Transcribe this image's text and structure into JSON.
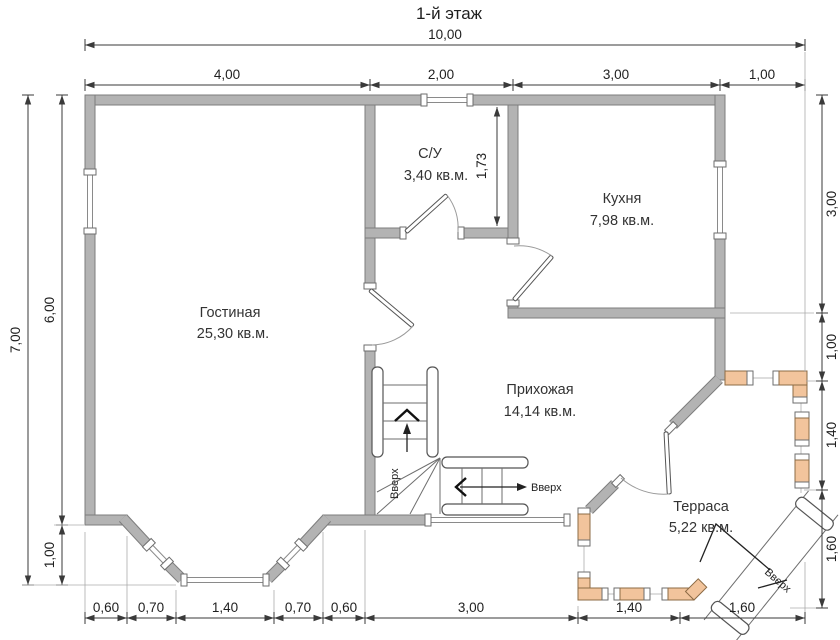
{
  "title": "1-й этаж",
  "rooms": [
    {
      "name": "Гостиная",
      "area": "25,30 кв.м."
    },
    {
      "name": "С/У",
      "area": "3,40 кв.м."
    },
    {
      "name": "Кухня",
      "area": "7,98 кв.м."
    },
    {
      "name": "Прихожая",
      "area": "14,14 кв.м."
    },
    {
      "name": "Терраса",
      "area": "5,22 кв.м."
    }
  ],
  "dims": {
    "top_total": "10,00",
    "top": [
      "4,00",
      "2,00",
      "3,00",
      "1,00"
    ],
    "left_total": "7,00",
    "left": [
      "6,00",
      "1,00"
    ],
    "right": [
      "3,00",
      "1,00",
      "1,40",
      "1,60"
    ],
    "bottom": [
      "0,60",
      "0,70",
      "1,40",
      "0,70",
      "0,60",
      "3,00",
      "1,40",
      "1,60"
    ],
    "wc_inner": "1,73"
  },
  "annotations": {
    "up1": "Вверх",
    "up2": "Вверх",
    "up3": "Вверх"
  },
  "colors": {
    "wall_fill": "#b3b3b3",
    "wall_edge": "#7d7d7d",
    "post_fill": "#f2c49c",
    "background": "#ffffff"
  }
}
